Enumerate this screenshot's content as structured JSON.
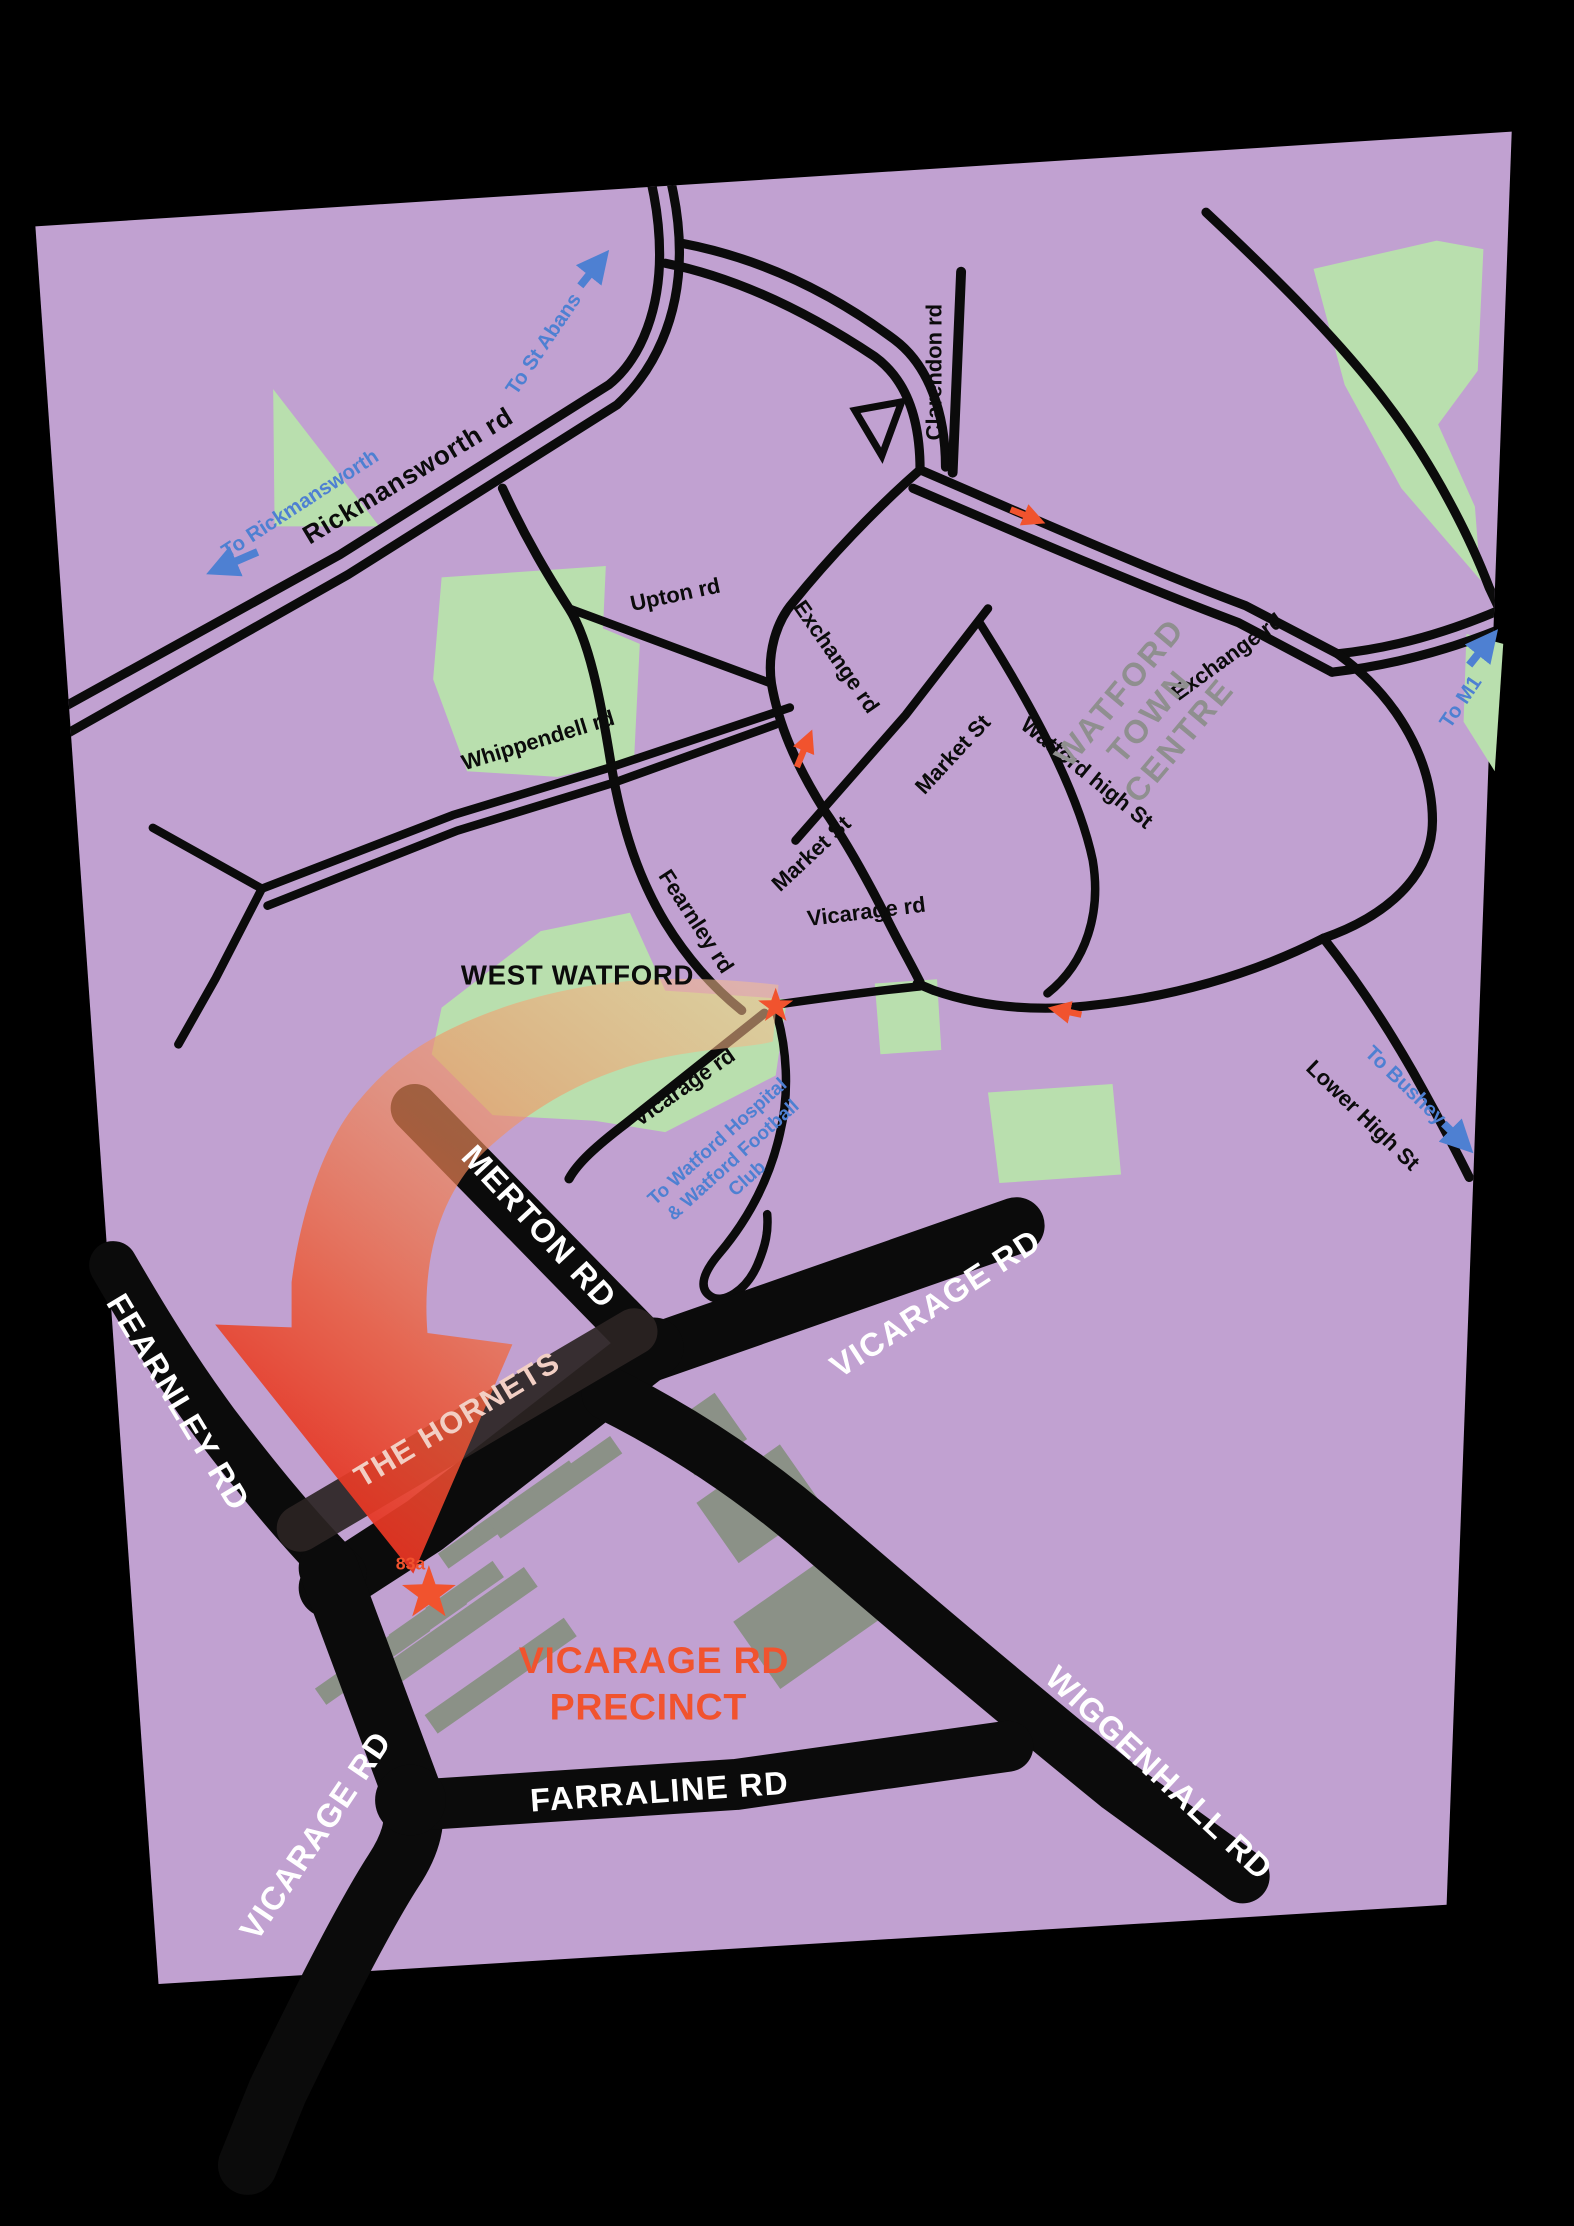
{
  "map": {
    "areas": {
      "west_watford": "WEST WATFORD",
      "watford_town_centre": [
        "WATFORD",
        "TOWN",
        "CENTRE"
      ],
      "vicarage_rd_precinct": [
        "VICARAGE RD",
        "PRECINCT"
      ],
      "precinct_address": "83a"
    },
    "streets": {
      "rickmansworth_rd": "Rickmansworth rd",
      "clarendon_rd": "Clarendon rd",
      "upton_rd": "Upton rd",
      "exchange_rd_west": "Exchange rd",
      "exchange_rd_east": "Exchange rd",
      "whippendell_rd": "Whippendell rd",
      "market_st_lower": "Market St",
      "market_st_upper": "Market St",
      "watford_high_st": "Watford high St",
      "vicarage_rd_town": "Vicarage rd",
      "fearnley_rd": "Fearnley rd",
      "vicarage_rd_west": "Vicarage rd",
      "lower_high_st": "Lower High St"
    },
    "directions": {
      "to_rickmansworth": "To Rickmansworth",
      "to_st_albans": "To St Abans",
      "to_m1": "To M1",
      "to_bushey": "To Bushey",
      "to_hospital": [
        "To Watford Hospital",
        "& Watford Football",
        "Club"
      ]
    },
    "inset": {
      "merton_rd": "MERTON RD",
      "fearnley_rd": "FEARNLEY RD",
      "vicarage_rd_ne": "VICARAGE RD",
      "the_hornets": "THE HORNETS",
      "wiggenhall_rd": "WIGGENHALL RD",
      "farraline_rd": "FARRALINE RD",
      "vicarage_rd_sw": "VICARAGE RD"
    },
    "colors": {
      "background": "#000000",
      "land": "#C1A1D1",
      "park": "#B9DFAE",
      "road": "#0B0B0B",
      "accent": "#F1532E",
      "blue": "#4E80D2",
      "gray_label": "#8F8F8F",
      "building": "#8B9187",
      "label_white": "#FFFFFF"
    }
  }
}
